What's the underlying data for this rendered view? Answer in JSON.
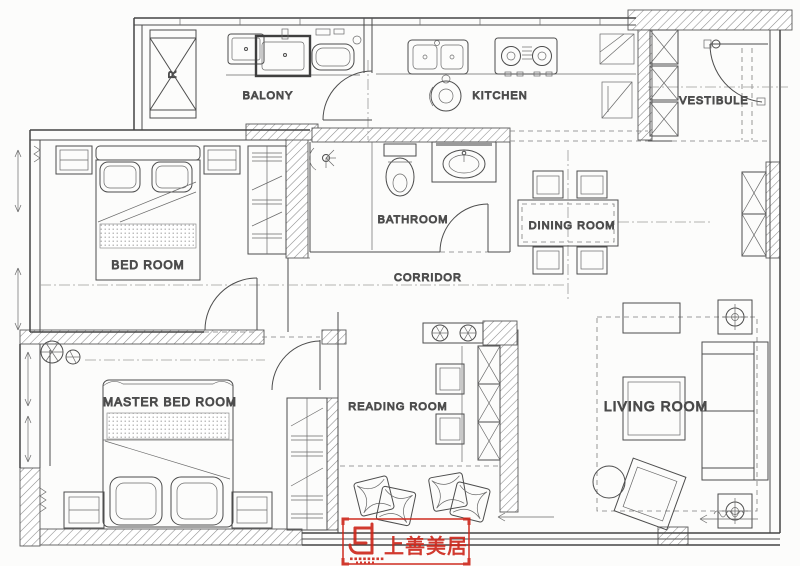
{
  "rooms": {
    "balcony": "BALONY",
    "kitchen": "KITCHEN",
    "vestibule": "VESTIBULE",
    "bedroom": "BED ROOM",
    "bathroom": "BATHROOM",
    "dining": "DINING ROOM",
    "corridor": "CORRIDOR",
    "master_bedroom": "MASTER BED ROOM",
    "reading": "READING ROOM",
    "living": "LIVING ROOM"
  },
  "annotations": {
    "washer_letter": "R"
  },
  "watermark": {
    "text": "上善美居",
    "color": "#cd2418"
  },
  "colors": {
    "line": "#4d4d4d",
    "wall": "#454545",
    "centerline": "#9a9a9a",
    "background": "#fcfcfb"
  }
}
